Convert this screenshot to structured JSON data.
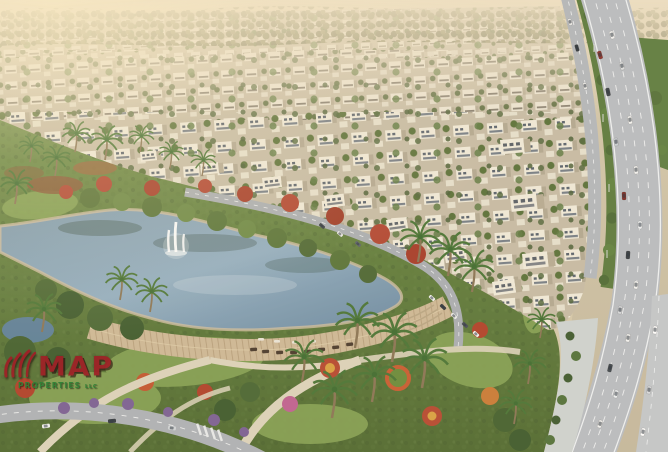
{
  "watermark": {
    "brand": "MAP",
    "tagline": "PROPERTIES",
    "suffix": "LLC",
    "brand_color": "#9e2127",
    "tagline_color": "#2f8036"
  }
}
